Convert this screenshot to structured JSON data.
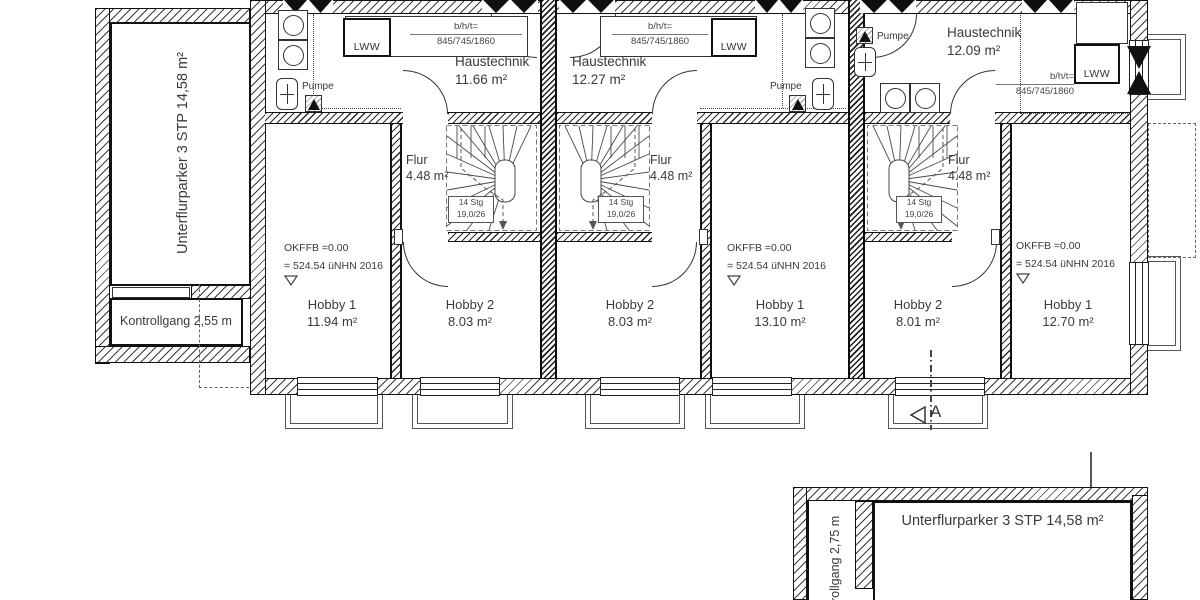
{
  "plan": {
    "left_annex": {
      "garage_label": "Unterflurparker 3 STP 14,58 m²",
      "corridor_label": "Kontrollgang 2,55 m"
    },
    "bottom_annex": {
      "garage_label": "Unterflurparker  3 STP  14,58 m²",
      "corridor_label": "rollgang 2,75 m"
    },
    "section_marker": "A",
    "units": [
      {
        "ht_name": "Haustechnik",
        "ht_area": "11.66 m²",
        "flur_name": "Flur",
        "flur_area": "4.48 m²",
        "h1_name": "Hobby 1",
        "h1_area": "11.94 m²",
        "h2_name": "Hobby 2",
        "h2_area": "8.03 m²",
        "stg1": "14 Stg",
        "stg2": "19,0/26",
        "lww": "LWW",
        "pump": "Pumpe",
        "dim1": "b/h/t=",
        "dim2": "845/745/1860",
        "lvl1": "OKFFB =0.00",
        "lvl2": "= 524.54 üNHN 2016"
      },
      {
        "ht_name": "Haustechnik",
        "ht_area": "12.27 m²",
        "flur_name": "Flur",
        "flur_area": "4.48 m²",
        "h1_name": "Hobby 1",
        "h1_area": "13.10 m²",
        "h2_name": "Hobby 2",
        "h2_area": "8.03 m²",
        "stg1": "14 Stg",
        "stg2": "19,0/26",
        "lww": "LWW",
        "pump": "Pumpe",
        "dim1": "b/h/t=",
        "dim2": "845/745/1860",
        "lvl1": "OKFFB =0.00",
        "lvl2": "= 524.54 üNHN 2016"
      },
      {
        "ht_name": "Haustechnik",
        "ht_area": "12.09 m²",
        "flur_name": "Flur",
        "flur_area": "4.48 m²",
        "h1_name": "Hobby 1",
        "h1_area": "12.70 m²",
        "h2_name": "Hobby 2",
        "h2_area": "8.01 m²",
        "stg1": "14 Stg",
        "stg2": "19,0/26",
        "lww": "LWW",
        "pump": "Pumpe",
        "dim1": "b/h/t=",
        "dim2": "845/745/1860",
        "lvl1": "OKFFB =0.00",
        "lvl2": "= 524.54 üNHN 2016"
      }
    ]
  }
}
